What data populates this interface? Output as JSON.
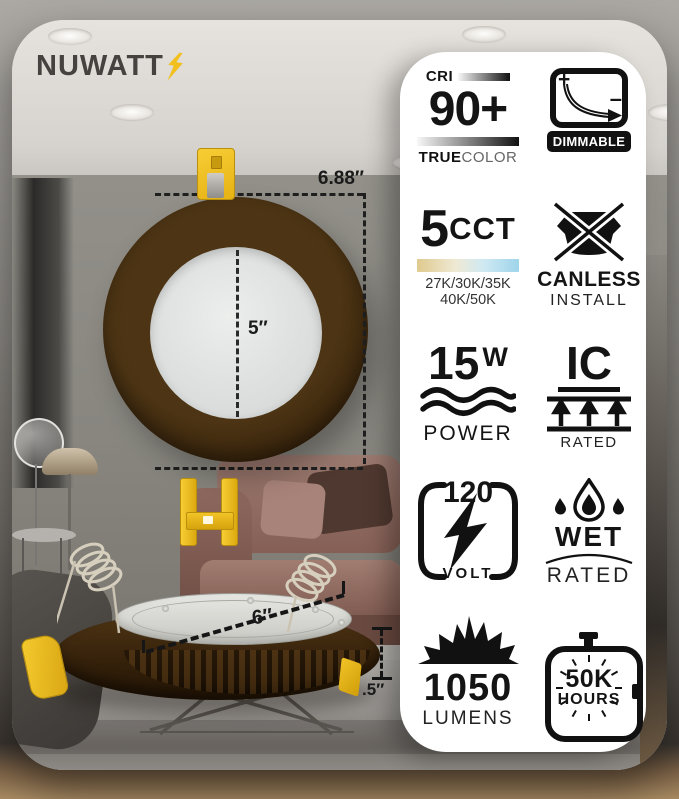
{
  "brand": {
    "name": "NUWATT"
  },
  "annotations": {
    "overall_width": "6.88″",
    "lens_diameter": "5″",
    "body_diameter": "6″",
    "profile_depth": ".5″"
  },
  "features": {
    "cri": {
      "label": "CRI",
      "value": "90+",
      "bold": "TRUE",
      "light": "COLOR"
    },
    "dimmable": {
      "label": "DIMMABLE",
      "plus": "+",
      "minus": "–"
    },
    "cct": {
      "value": "5",
      "unit": "CCT",
      "temps1": "27K/30K/35K",
      "temps2": "40K/50K"
    },
    "canless": {
      "line1": "CANLESS",
      "line2": "INSTALL"
    },
    "power": {
      "value": "15",
      "unit": "W",
      "label": "POWER"
    },
    "ic": {
      "value": "IC",
      "label": "RATED"
    },
    "volt": {
      "value": "120",
      "label": "VOLT"
    },
    "wet": {
      "line1": "WET",
      "line2": "RATED"
    },
    "lumens": {
      "value": "1050",
      "label": "LUMENS"
    },
    "hours": {
      "value": "50K",
      "label": "HOURS"
    }
  },
  "colors": {
    "accent_yellow": "#F2C01E",
    "fixture_brown": "#3E2A10",
    "panel_bg": "#FFFFFF",
    "cct_warm": "#DFCA8E",
    "cct_cool": "#9FD4EA"
  }
}
